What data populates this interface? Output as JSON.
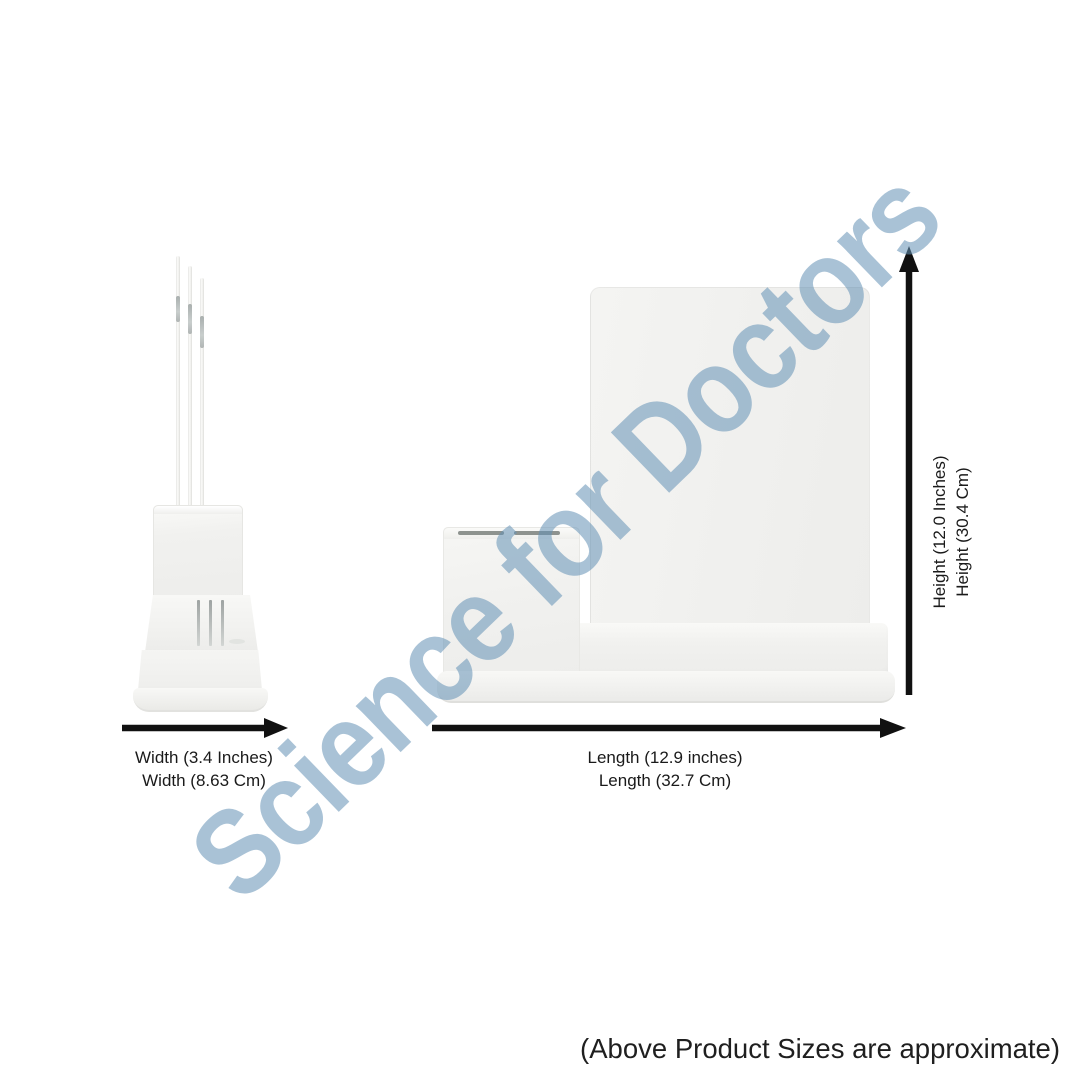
{
  "watermark": {
    "text": "Science for Doctors"
  },
  "dimensions": {
    "width": {
      "inches": "Width (3.4 Inches)",
      "cm": "Width (8.63 Cm)"
    },
    "length": {
      "inches": "Length (12.9 inches)",
      "cm": "Length (32.7 Cm)"
    },
    "height": {
      "inches": "Height (12.0 Inches)",
      "cm": "Height (30.4 Cm)"
    }
  },
  "note": "(Above Product Sizes are approximate)",
  "colors": {
    "background": "#FFFFFF",
    "arrow": "#111111",
    "label_text": "#1A1A1A",
    "note_text": "#1F1F1F",
    "watermark": "#6492B6",
    "product_body": "#F3F3F1",
    "product_edge": "#E1E1DE"
  }
}
